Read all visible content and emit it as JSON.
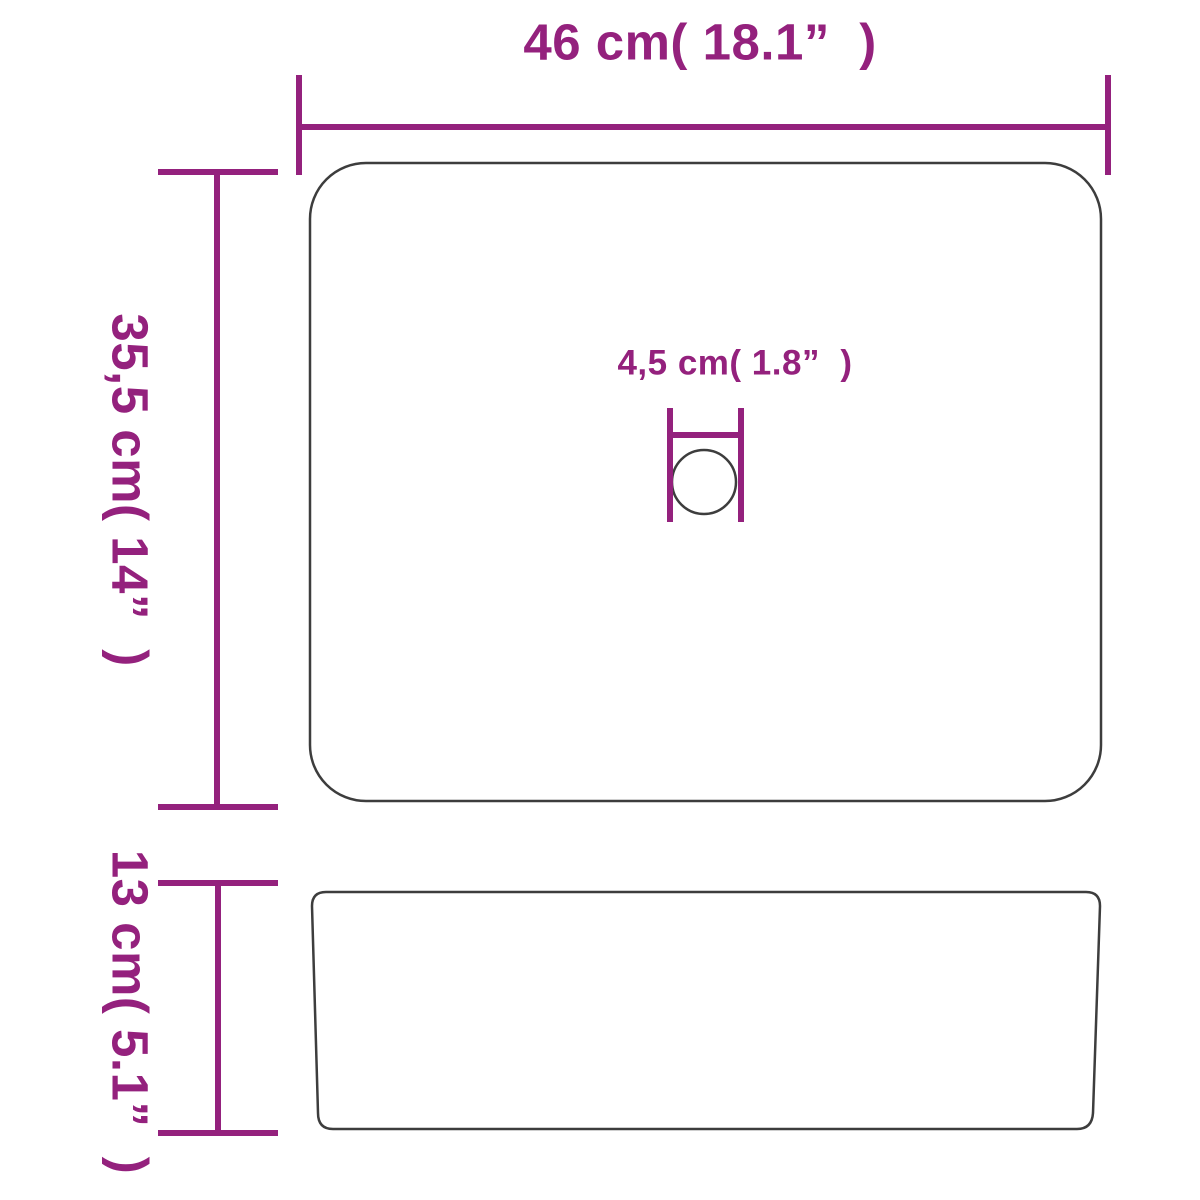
{
  "title": "Product dimension diagram (basin top view and side view)",
  "colors": {
    "dimension": "#94217d",
    "outline": "#3d3d3d",
    "background": "#ffffff"
  },
  "labels": {
    "width": "46 cm( 18.1”  )",
    "depth": "35,5 cm( 14”  )",
    "hole": "4,5 cm( 1.8”  )",
    "height": "13 cm( 5.1”  )"
  },
  "dimensions": {
    "width": {
      "cm": "46",
      "inches": "18.1"
    },
    "depth": {
      "cm": "35,5",
      "inches": "14"
    },
    "hole": {
      "cm": "4,5",
      "inches": "1.8"
    },
    "height": {
      "cm": "13",
      "inches": "5.1"
    }
  }
}
